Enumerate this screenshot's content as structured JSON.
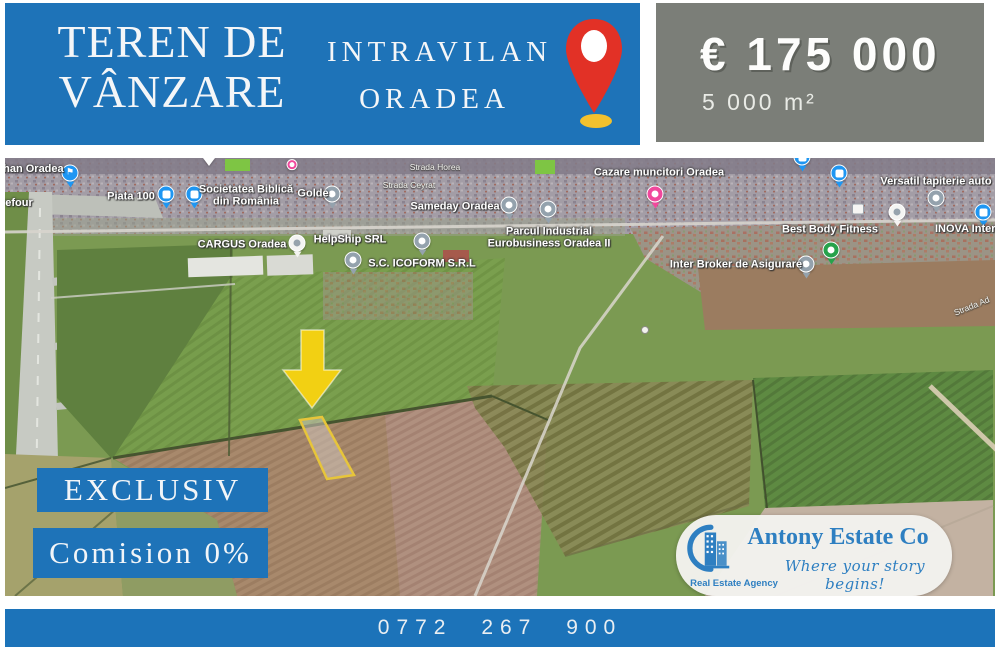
{
  "header": {
    "title": [
      "TEREN DE",
      "VÂNZARE"
    ],
    "location": [
      "INTRAVILAN",
      "ORADEA"
    ],
    "price": "€ 175 000",
    "area": "5 000 m²"
  },
  "map": {
    "labels": [
      {
        "text": "ehan Oradea"
      },
      {
        "text": "refour"
      },
      {
        "text": "Piata 100"
      },
      {
        "text": "Societatea Biblică",
        "text2": "din România"
      },
      {
        "text": "Golde"
      },
      {
        "text": "Sameday Oradea"
      },
      {
        "text": "CARGUS Oradea"
      },
      {
        "text": "HelpShip SRL"
      },
      {
        "text": "S.C. ICOFORM S.R.L"
      },
      {
        "text": "Parcul Industrial",
        "text2": "Eurobusiness Oradea II"
      },
      {
        "text": "Cazare muncitori Oradea"
      },
      {
        "text": "Versatil tapiterie auto"
      },
      {
        "text": "Best Body Fitness"
      },
      {
        "text": "INOVA Internat"
      },
      {
        "text": "Inter Broker de Asigurare"
      },
      {
        "text": "Strada Horea"
      },
      {
        "text": "Strada Ceyrat"
      },
      {
        "text": "Strada Ad"
      }
    ]
  },
  "badges": {
    "exclusiv": "EXCLUSIV",
    "comision": "Comision 0%"
  },
  "logo": {
    "name": "Antony Estate Co",
    "tagline": "Where your story begins!",
    "agency": "Real Estate Agency"
  },
  "footer": {
    "phone": "0772 267 900"
  },
  "icons": {
    "location-pin": "red teardrop with white center and yellow base",
    "flag-pin": "⚑",
    "cart-pin": "blue circle white glyph",
    "lock-pin": "blue circle white glyph",
    "poi-pin": "gray circle white dot",
    "fitness-pin": "green circle white dot",
    "lodging-pin": "pink circle white dot",
    "arrow-down": "yellow solid arrow",
    "logo-buildings": "blue buildings with swoosh"
  },
  "colors": {
    "banner_blue": "#1e73b8",
    "panel_gray": "#7b7e78",
    "footer_blue": "#1c73b9",
    "arrow_yellow": "#f2d013",
    "plot_outline_yellow": "#e7c53a",
    "logo_blue": "#2e7fc1",
    "pin_blue": "#1e96f2",
    "pin_green": "#27a24b",
    "pin_pink": "#f0489c"
  }
}
